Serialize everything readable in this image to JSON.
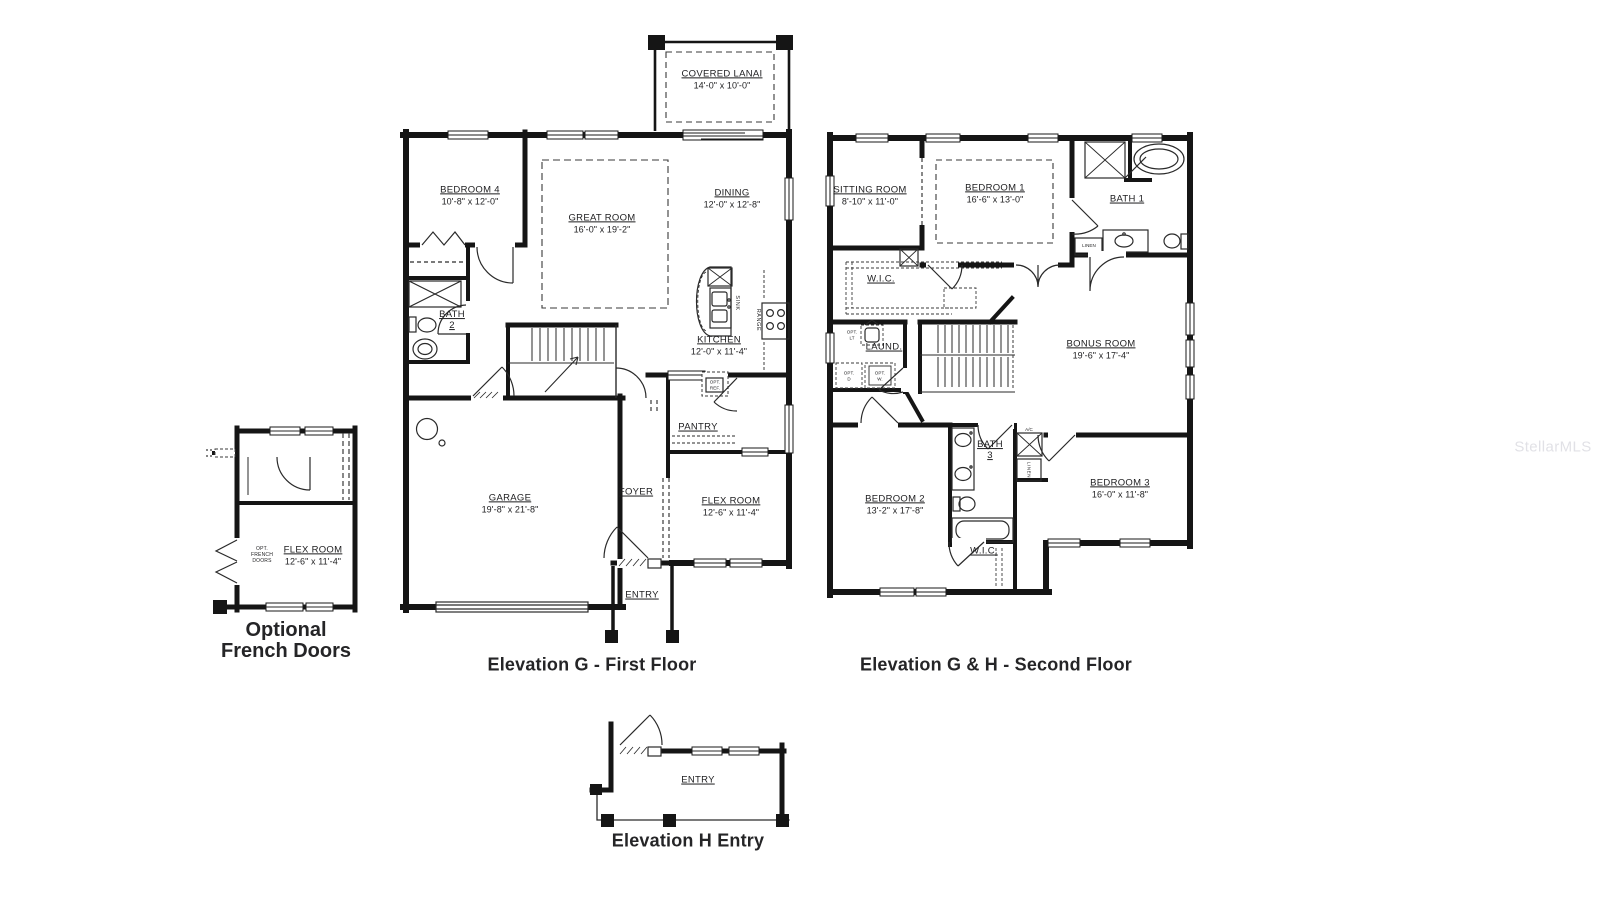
{
  "watermark": "StellarMLS",
  "inset": {
    "caption_line1": "Optional",
    "caption_line2": "French Doors",
    "flex_room": {
      "name": "FLEX ROOM",
      "dims": "12'-6\" x 11'-4\""
    },
    "opt_note_line1": "OPT.",
    "opt_note_line2": "FRENCH",
    "opt_note_line3": "DOORS"
  },
  "first_floor": {
    "caption": "Elevation G - First Floor",
    "covered_lanai": {
      "name": "COVERED LANAI",
      "dims": "14'-0\" x 10'-0\""
    },
    "bedroom4": {
      "name": "BEDROOM 4",
      "dims": "10'-8\" x 12'-0\""
    },
    "great_room": {
      "name": "GREAT ROOM",
      "dims": "16'-0\" x 19'-2\""
    },
    "dining": {
      "name": "DINING",
      "dims": "12'-0\" x 12'-8\""
    },
    "kitchen": {
      "name": "KITCHEN",
      "dims": "12'-0\" x 11'-4\""
    },
    "bath2": {
      "name": "BATH",
      "number": "2"
    },
    "garage": {
      "name": "GARAGE",
      "dims": "19'-8\" x 21'-8\""
    },
    "foyer": {
      "name": "FOYER"
    },
    "pantry": {
      "name": "PANTRY"
    },
    "flex_room": {
      "name": "FLEX ROOM",
      "dims": "12'-6\" x 11'-4\""
    },
    "entry": {
      "name": "ENTRY"
    },
    "sink_label": "SINK",
    "range_label": "RANGE",
    "opt_ref_line1": "OPT.",
    "opt_ref_line2": "REF."
  },
  "second_floor": {
    "caption": "Elevation G & H - Second Floor",
    "sitting_room": {
      "name": "SITTING ROOM",
      "dims": "8'-10\" x 11'-0\""
    },
    "bedroom1": {
      "name": "BEDROOM 1",
      "dims": "16'-6\" x 13'-0\""
    },
    "bath1": {
      "name": "BATH 1"
    },
    "wic": {
      "name": "W.I.C."
    },
    "laundry": {
      "name": "LAUND."
    },
    "bonus_room": {
      "name": "BONUS ROOM",
      "dims": "19'-6\" x 17'-4\""
    },
    "bedroom2": {
      "name": "BEDROOM 2",
      "dims": "13'-2\" x 17'-8\""
    },
    "bath3": {
      "name": "BATH",
      "number": "3"
    },
    "wic2": {
      "name": "W.I.C."
    },
    "bedroom3": {
      "name": "BEDROOM 3",
      "dims": "16'-0\" x 11'-8\""
    },
    "linen_bath1": "LINEN",
    "linen_hall": "LINEN",
    "ac_label": "A/C",
    "opt_lt_line1": "OPT.",
    "opt_lt_line2": "LT",
    "opt_d_line1": "OPT.",
    "opt_d_line2": "D",
    "opt_w_line1": "OPT.",
    "opt_w_line2": "W."
  },
  "entry_elevation": {
    "caption": "Elevation H Entry",
    "entry": {
      "name": "ENTRY"
    }
  }
}
